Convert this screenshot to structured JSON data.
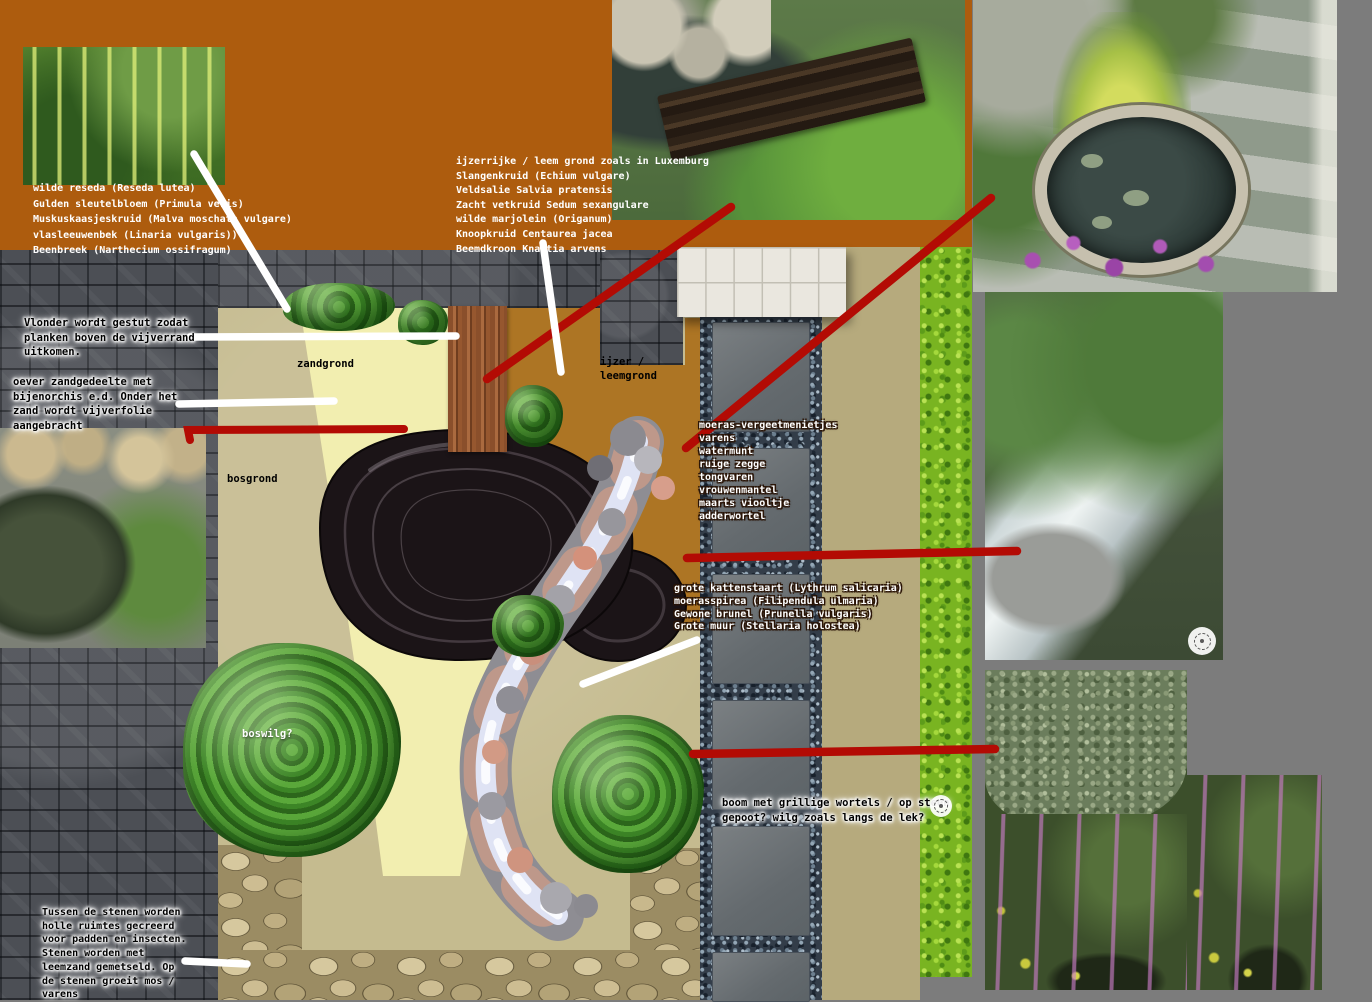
{
  "colors": {
    "orange_block": "#ad5c0e",
    "canvas_grey": "#7c7c7c",
    "cobble_grey": "#4c4f55",
    "red_line": "#b30b04",
    "white_line": "#ffffff",
    "zandgrond_yellow": "#f2eeb0",
    "leemgrond_ochre": "#ad7524",
    "bosgrond_beige": "#c5bb8f",
    "path_tan": "#b6aa7d",
    "hedge_green": "#79b421"
  },
  "icons": {
    "watermark": "dashed-circle-camera"
  },
  "lists": {
    "reseda": [
      "wilde reseda (Reseda lutea)",
      "Gulden sleutelbloem (Primula veris)",
      "Muskuskaasjeskruid (Malva moschata vulgare)",
      "vlasleeuwenbek (Linaria vulgaris))",
      "Beenbreek (Narthecium ossifragum)"
    ],
    "luxemburg": [
      "ijzerrijke / leem grond zoals in Luxemburg",
      "Slangenkruid (Echium vulgare)",
      "Veldsalie Salvia pratensis",
      "Zacht vetkruid Sedum sexangulare",
      "wilde marjolein (Origanum)",
      "Knoopkruid Centaurea jacea",
      "Beemdkroon Knautia arvens"
    ],
    "moeras": [
      "moeras-vergeetmenietjes",
      "varens",
      "watermunt",
      "ruige zegge",
      "tongvaren",
      "vrouwenmantel",
      "maarts viooltje",
      "adderwortel"
    ],
    "kattenstaart": [
      "grote kattenstaart (Lythrum salicaria)",
      "moerasspirea (Filipendula ulmaria)",
      "Gewone brunel (Prunella vulgaris)",
      "Grote muur (Stellaria holostea)"
    ]
  },
  "notes": {
    "vlonder": "Vlonder wordt gestut zodat\nplanken boven de vijverrand\nuitkomen.",
    "oever": "oever zandgedeelte met\nbijenorchis e.d. Onder het\nzand wordt vijverfolie\naangebracht",
    "boom": "boom met grillige wortels / op steen\ngepoot? wilg zoals langs de lek?",
    "stenen": "Tussen de stenen worden\nholle ruimtes gecreerd\nvoor padden en insecten.\nStenen worden met\nleemzand gemetseld. Op\nde stenen groeit mos /\nvarens"
  },
  "plan_labels": {
    "zand": "zandgrond",
    "leem": "ijzer /\nleemgrond",
    "bos": "bosgrond",
    "boswilg": "boswilg?"
  }
}
